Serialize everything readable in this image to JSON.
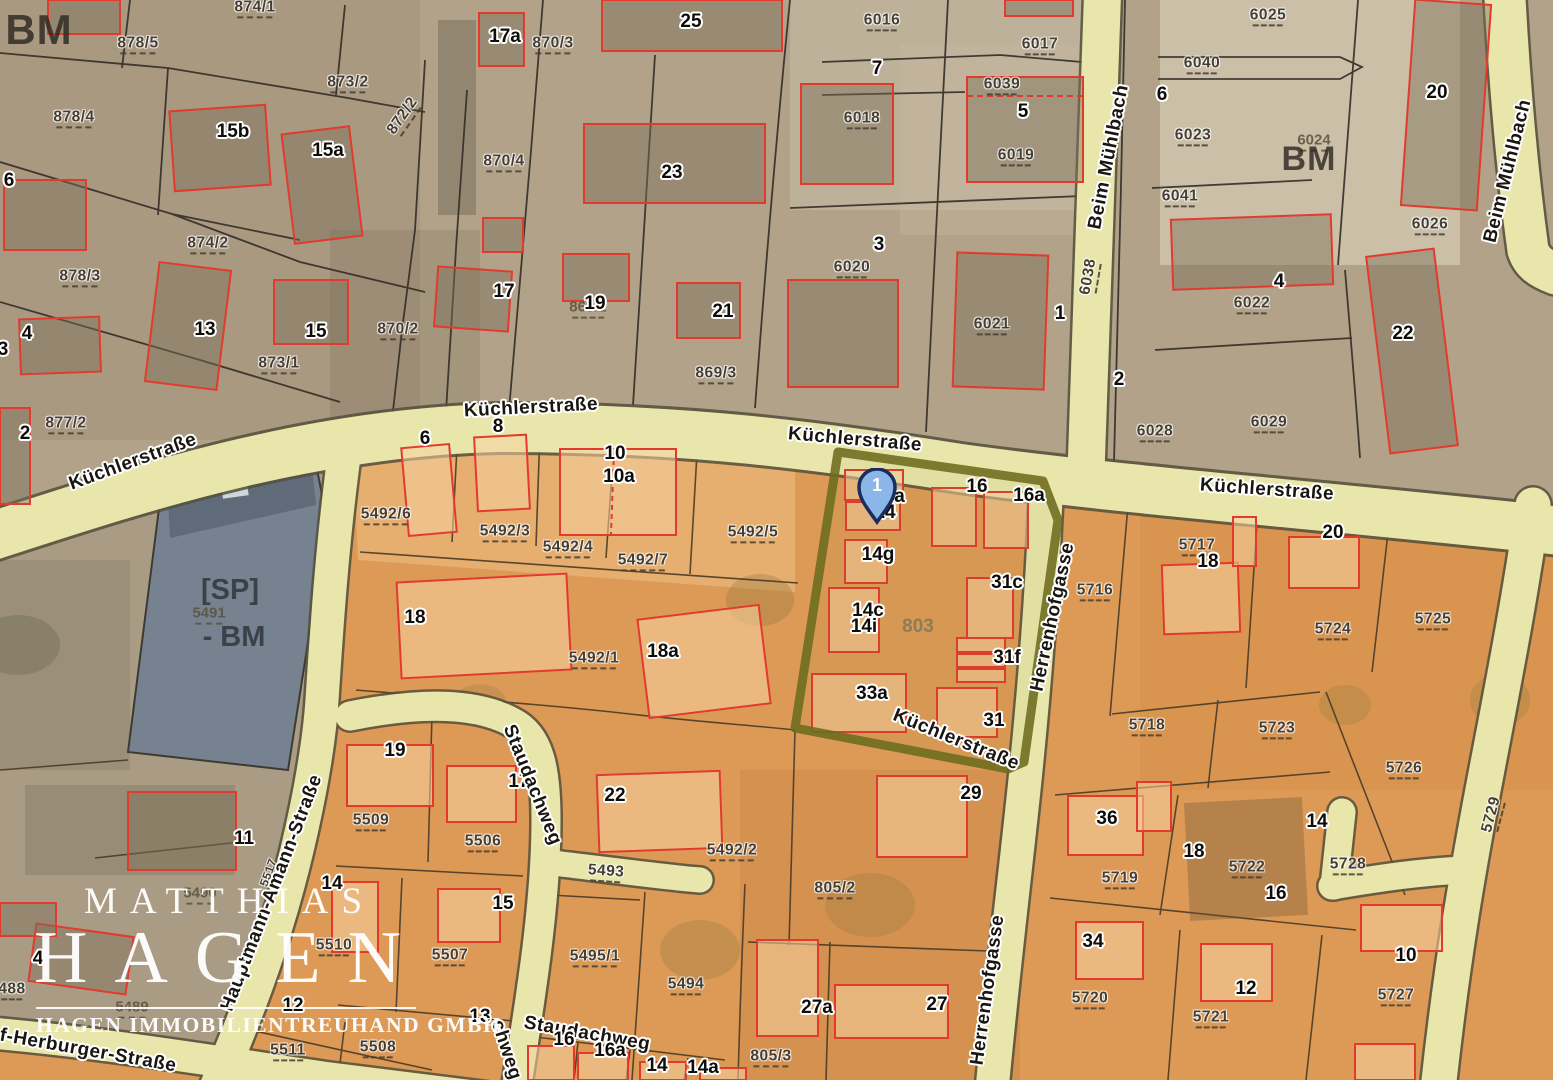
{
  "title": "Katasterplan / Grundstücksplan",
  "pin": {
    "label": "1"
  },
  "watermark": {
    "line1": "MATTHIAS",
    "line2": "HAGEN",
    "subtitle": "HAGEN IMMOBILIENTREUHAND GMBH"
  },
  "palette": {
    "street_fill": "#e9e6ab",
    "street_casing": "#55503c",
    "upper_ground": "#b1a289",
    "lower_ground": "#dd9a57",
    "building_outline_red": "#e23b2d",
    "highlight_olive": "#6c6c1e",
    "sp_area_blue_gray": "#76828f",
    "pin_blue": "#8ab7e8",
    "pin_border": "#1b2c5f"
  },
  "map_labels": [
    {
      "t": "BM",
      "x": 39,
      "y": 30,
      "c": "bm",
      "s": 42
    },
    {
      "t": "874/1",
      "x": 255,
      "y": 9,
      "c": "p"
    },
    {
      "t": "878/5",
      "x": 138,
      "y": 45,
      "c": "p"
    },
    {
      "t": "873/2",
      "x": 348,
      "y": 84,
      "c": "p"
    },
    {
      "t": "872/2",
      "x": 404,
      "y": 117,
      "r": -55,
      "c": "p"
    },
    {
      "t": "878/4",
      "x": 74,
      "y": 119,
      "c": "p"
    },
    {
      "t": "15b",
      "x": 233,
      "y": 132,
      "c": "h"
    },
    {
      "t": "15a",
      "x": 328,
      "y": 151,
      "c": "h"
    },
    {
      "t": "6",
      "x": 9,
      "y": 181,
      "c": "h"
    },
    {
      "t": "874/2",
      "x": 208,
      "y": 245,
      "c": "p"
    },
    {
      "t": "17a",
      "x": 505,
      "y": 37,
      "c": "h"
    },
    {
      "t": "870/3",
      "x": 553,
      "y": 45,
      "c": "p"
    },
    {
      "t": "25",
      "x": 691,
      "y": 22,
      "c": "h"
    },
    {
      "t": "870/4",
      "x": 504,
      "y": 163,
      "c": "p"
    },
    {
      "t": "23",
      "x": 672,
      "y": 173,
      "c": "h"
    },
    {
      "t": "6016",
      "x": 882,
      "y": 22,
      "c": "p"
    },
    {
      "t": "6017",
      "x": 1040,
      "y": 46,
      "c": "p"
    },
    {
      "t": "7",
      "x": 877,
      "y": 69,
      "c": "h"
    },
    {
      "t": "6039",
      "x": 1002,
      "y": 86,
      "c": "p"
    },
    {
      "t": "5",
      "x": 1023,
      "y": 112,
      "c": "h"
    },
    {
      "t": "6018",
      "x": 862,
      "y": 120,
      "c": "p"
    },
    {
      "t": "6019",
      "x": 1016,
      "y": 157,
      "c": "p"
    },
    {
      "t": "6040",
      "x": 1202,
      "y": 65,
      "c": "p"
    },
    {
      "t": "6",
      "x": 1162,
      "y": 95,
      "c": "h"
    },
    {
      "t": "6023",
      "x": 1193,
      "y": 137,
      "c": "p"
    },
    {
      "t": "6041",
      "x": 1180,
      "y": 198,
      "c": "p"
    },
    {
      "t": "Beim Mühlbach",
      "x": 1109,
      "y": 157,
      "r": -79,
      "c": "s"
    },
    {
      "t": "6025",
      "x": 1268,
      "y": 17,
      "c": "p"
    },
    {
      "t": "6024",
      "x": 1314,
      "y": 142,
      "c": "g"
    },
    {
      "t": "BM",
      "x": 1309,
      "y": 160,
      "c": "bm",
      "s": 34
    },
    {
      "t": "20",
      "x": 1437,
      "y": 93,
      "c": "h"
    },
    {
      "t": "6026",
      "x": 1430,
      "y": 226,
      "c": "p"
    },
    {
      "t": "Beim Mühlbach",
      "x": 1508,
      "y": 171,
      "r": -76,
      "c": "s"
    },
    {
      "t": "878/3",
      "x": 80,
      "y": 278,
      "c": "p"
    },
    {
      "t": "4",
      "x": 27,
      "y": 334,
      "c": "h"
    },
    {
      "t": "3",
      "x": 3,
      "y": 350,
      "c": "h"
    },
    {
      "t": "13",
      "x": 205,
      "y": 330,
      "c": "h"
    },
    {
      "t": "15",
      "x": 316,
      "y": 332,
      "c": "h"
    },
    {
      "t": "873/1",
      "x": 279,
      "y": 365,
      "c": "p"
    },
    {
      "t": "870/2",
      "x": 398,
      "y": 331,
      "c": "p"
    },
    {
      "t": "877/2",
      "x": 66,
      "y": 425,
      "c": "p"
    },
    {
      "t": "2",
      "x": 25,
      "y": 434,
      "c": "h"
    },
    {
      "t": "17",
      "x": 504,
      "y": 292,
      "c": "h"
    },
    {
      "t": "869/2",
      "x": 588,
      "y": 309,
      "c": "g"
    },
    {
      "t": "19",
      "x": 595,
      "y": 304,
      "c": "h"
    },
    {
      "t": "21",
      "x": 723,
      "y": 312,
      "c": "h"
    },
    {
      "t": "869/3",
      "x": 716,
      "y": 375,
      "c": "p"
    },
    {
      "t": "6020",
      "x": 852,
      "y": 269,
      "c": "p"
    },
    {
      "t": "3",
      "x": 879,
      "y": 245,
      "c": "h"
    },
    {
      "t": "6021",
      "x": 992,
      "y": 326,
      "c": "p"
    },
    {
      "t": "1",
      "x": 1060,
      "y": 314,
      "c": "h"
    },
    {
      "t": "6038",
      "x": 1090,
      "y": 277,
      "r": -80,
      "c": "p"
    },
    {
      "t": "2",
      "x": 1119,
      "y": 380,
      "c": "h"
    },
    {
      "t": "6028",
      "x": 1155,
      "y": 433,
      "c": "p"
    },
    {
      "t": "4",
      "x": 1279,
      "y": 282,
      "c": "h"
    },
    {
      "t": "6022",
      "x": 1252,
      "y": 305,
      "c": "p"
    },
    {
      "t": "22",
      "x": 1403,
      "y": 334,
      "c": "h"
    },
    {
      "t": "6029",
      "x": 1269,
      "y": 424,
      "c": "p"
    },
    {
      "t": "Küchlerstraße",
      "x": 133,
      "y": 462,
      "r": -20,
      "c": "s"
    },
    {
      "t": "Küchlerstraße",
      "x": 531,
      "y": 408,
      "r": -3,
      "c": "s"
    },
    {
      "t": "Küchlerstraße",
      "x": 855,
      "y": 440,
      "r": 5,
      "c": "s"
    },
    {
      "t": "Küchlerstraße",
      "x": 1267,
      "y": 490,
      "r": 4,
      "c": "s"
    },
    {
      "t": "Küchlerstraße",
      "x": 956,
      "y": 740,
      "r": 22,
      "c": "s"
    },
    {
      "t": "[SP]",
      "x": 230,
      "y": 590,
      "c": "sp"
    },
    {
      "t": "5491",
      "x": 209,
      "y": 615,
      "c": "g"
    },
    {
      "t": "- BM",
      "x": 234,
      "y": 637,
      "c": "sp"
    },
    {
      "t": "6",
      "x": 425,
      "y": 439,
      "c": "h"
    },
    {
      "t": "8",
      "x": 498,
      "y": 427,
      "c": "h"
    },
    {
      "t": "10",
      "x": 615,
      "y": 454,
      "c": "h"
    },
    {
      "t": "10a",
      "x": 619,
      "y": 477,
      "c": "h"
    },
    {
      "t": "5492/6",
      "x": 386,
      "y": 516,
      "c": "p"
    },
    {
      "t": "5492/3",
      "x": 505,
      "y": 533,
      "c": "p"
    },
    {
      "t": "5492/4",
      "x": 568,
      "y": 549,
      "c": "p"
    },
    {
      "t": "5492/7",
      "x": 643,
      "y": 562,
      "c": "p"
    },
    {
      "t": "5492/5",
      "x": 753,
      "y": 534,
      "c": "p"
    },
    {
      "t": "18",
      "x": 415,
      "y": 618,
      "c": "h"
    },
    {
      "t": "5492/1",
      "x": 594,
      "y": 660,
      "c": "p"
    },
    {
      "t": "18a",
      "x": 663,
      "y": 652,
      "c": "h"
    },
    {
      "t": "14a",
      "x": 889,
      "y": 497,
      "c": "h"
    },
    {
      "t": "14",
      "x": 885,
      "y": 513,
      "c": "h"
    },
    {
      "t": "16",
      "x": 977,
      "y": 487,
      "c": "h"
    },
    {
      "t": "16a",
      "x": 1029,
      "y": 496,
      "c": "h"
    },
    {
      "t": "14g",
      "x": 878,
      "y": 555,
      "c": "h"
    },
    {
      "t": "31c",
      "x": 1007,
      "y": 583,
      "c": "h"
    },
    {
      "t": "14c",
      "x": 868,
      "y": 611,
      "c": "h"
    },
    {
      "t": "14i",
      "x": 864,
      "y": 627,
      "c": "h"
    },
    {
      "t": "803",
      "x": 918,
      "y": 627,
      "c": "gn"
    },
    {
      "t": "31f",
      "x": 1007,
      "y": 658,
      "c": "h"
    },
    {
      "t": "33a",
      "x": 872,
      "y": 694,
      "c": "h"
    },
    {
      "t": "31",
      "x": 994,
      "y": 721,
      "c": "h"
    },
    {
      "t": "Herrenhofgasse",
      "x": 1053,
      "y": 617,
      "r": -78,
      "c": "s"
    },
    {
      "t": "5716",
      "x": 1095,
      "y": 592,
      "c": "p"
    },
    {
      "t": "5717",
      "x": 1197,
      "y": 547,
      "c": "p"
    },
    {
      "t": "18",
      "x": 1208,
      "y": 562,
      "c": "h"
    },
    {
      "t": "20",
      "x": 1333,
      "y": 533,
      "c": "h"
    },
    {
      "t": "5725",
      "x": 1433,
      "y": 621,
      "c": "p"
    },
    {
      "t": "5724",
      "x": 1333,
      "y": 631,
      "c": "p"
    },
    {
      "t": "5718",
      "x": 1147,
      "y": 727,
      "c": "p"
    },
    {
      "t": "5723",
      "x": 1277,
      "y": 730,
      "c": "p"
    },
    {
      "t": "5726",
      "x": 1404,
      "y": 770,
      "c": "p"
    },
    {
      "t": "5729",
      "x": 1493,
      "y": 815,
      "r": -75,
      "c": "p"
    },
    {
      "t": "19",
      "x": 395,
      "y": 751,
      "c": "h"
    },
    {
      "t": "5509",
      "x": 371,
      "y": 822,
      "c": "p"
    },
    {
      "t": "17",
      "x": 519,
      "y": 782,
      "c": "h"
    },
    {
      "t": "5506",
      "x": 483,
      "y": 843,
      "c": "p"
    },
    {
      "t": "Staudachweg",
      "x": 532,
      "y": 785,
      "r": 68,
      "c": "s"
    },
    {
      "t": "22",
      "x": 615,
      "y": 796,
      "c": "h"
    },
    {
      "t": "5492/2",
      "x": 732,
      "y": 852,
      "c": "p"
    },
    {
      "t": "5493",
      "x": 606,
      "y": 873,
      "r": 4,
      "c": "p"
    },
    {
      "t": "15",
      "x": 503,
      "y": 904,
      "c": "h"
    },
    {
      "t": "5507",
      "x": 450,
      "y": 957,
      "c": "p"
    },
    {
      "t": "5495/1",
      "x": 595,
      "y": 958,
      "c": "p"
    },
    {
      "t": "5494",
      "x": 686,
      "y": 986,
      "c": "p"
    },
    {
      "t": "29",
      "x": 971,
      "y": 794,
      "c": "h"
    },
    {
      "t": "805/2",
      "x": 835,
      "y": 890,
      "c": "p"
    },
    {
      "t": "27a",
      "x": 817,
      "y": 1008,
      "c": "h"
    },
    {
      "t": "27",
      "x": 937,
      "y": 1005,
      "c": "h"
    },
    {
      "t": "805/3",
      "x": 771,
      "y": 1058,
      "c": "p"
    },
    {
      "t": "Herrenhofgasse",
      "x": 988,
      "y": 990,
      "r": -82,
      "c": "s"
    },
    {
      "t": "36",
      "x": 1107,
      "y": 819,
      "c": "h"
    },
    {
      "t": "5719",
      "x": 1120,
      "y": 880,
      "c": "p"
    },
    {
      "t": "18",
      "x": 1194,
      "y": 852,
      "c": "h"
    },
    {
      "t": "5722",
      "x": 1247,
      "y": 869,
      "c": "p"
    },
    {
      "t": "14",
      "x": 1317,
      "y": 822,
      "c": "h"
    },
    {
      "t": "16",
      "x": 1276,
      "y": 894,
      "c": "h"
    },
    {
      "t": "5728",
      "x": 1348,
      "y": 866,
      "c": "p"
    },
    {
      "t": "34",
      "x": 1093,
      "y": 942,
      "c": "h"
    },
    {
      "t": "5720",
      "x": 1090,
      "y": 1000,
      "c": "p"
    },
    {
      "t": "12",
      "x": 1246,
      "y": 989,
      "c": "h"
    },
    {
      "t": "5721",
      "x": 1211,
      "y": 1019,
      "c": "p"
    },
    {
      "t": "10",
      "x": 1406,
      "y": 956,
      "c": "h"
    },
    {
      "t": "5727",
      "x": 1396,
      "y": 997,
      "c": "p"
    },
    {
      "t": "11",
      "x": 244,
      "y": 839,
      "c": "h"
    },
    {
      "t": "5490",
      "x": 200,
      "y": 895,
      "c": "g"
    },
    {
      "t": "4",
      "x": 38,
      "y": 959,
      "c": "h"
    },
    {
      "t": "488",
      "x": 12,
      "y": 991,
      "c": "p"
    },
    {
      "t": "5489",
      "x": 132,
      "y": 1009,
      "c": "g"
    },
    {
      "t": "5517",
      "x": 270,
      "y": 873,
      "r": -70,
      "c": "p",
      "s": 12
    },
    {
      "t": "Hauptmann-Amann-Straße",
      "x": 272,
      "y": 893,
      "r": -69,
      "c": "s"
    },
    {
      "t": "f-Herburger-Straße",
      "x": 88,
      "y": 1051,
      "r": 10,
      "c": "s"
    },
    {
      "t": "14",
      "x": 332,
      "y": 884,
      "c": "h"
    },
    {
      "t": "5510",
      "x": 334,
      "y": 947,
      "c": "p"
    },
    {
      "t": "12",
      "x": 293,
      "y": 1006,
      "c": "h"
    },
    {
      "t": "5511",
      "x": 288,
      "y": 1052,
      "c": "p"
    },
    {
      "t": "5508",
      "x": 378,
      "y": 1049,
      "c": "p"
    },
    {
      "t": "13",
      "x": 480,
      "y": 1017,
      "c": "h"
    },
    {
      "t": "Staudachweg",
      "x": 587,
      "y": 1034,
      "r": 10,
      "c": "s"
    },
    {
      "t": "chweg",
      "x": 506,
      "y": 1050,
      "r": 72,
      "c": "s"
    },
    {
      "t": "16",
      "x": 564,
      "y": 1040,
      "c": "h"
    },
    {
      "t": "16a",
      "x": 610,
      "y": 1051,
      "c": "h"
    },
    {
      "t": "14",
      "x": 657,
      "y": 1066,
      "c": "h"
    },
    {
      "t": "14a",
      "x": 703,
      "y": 1068,
      "c": "h"
    }
  ]
}
